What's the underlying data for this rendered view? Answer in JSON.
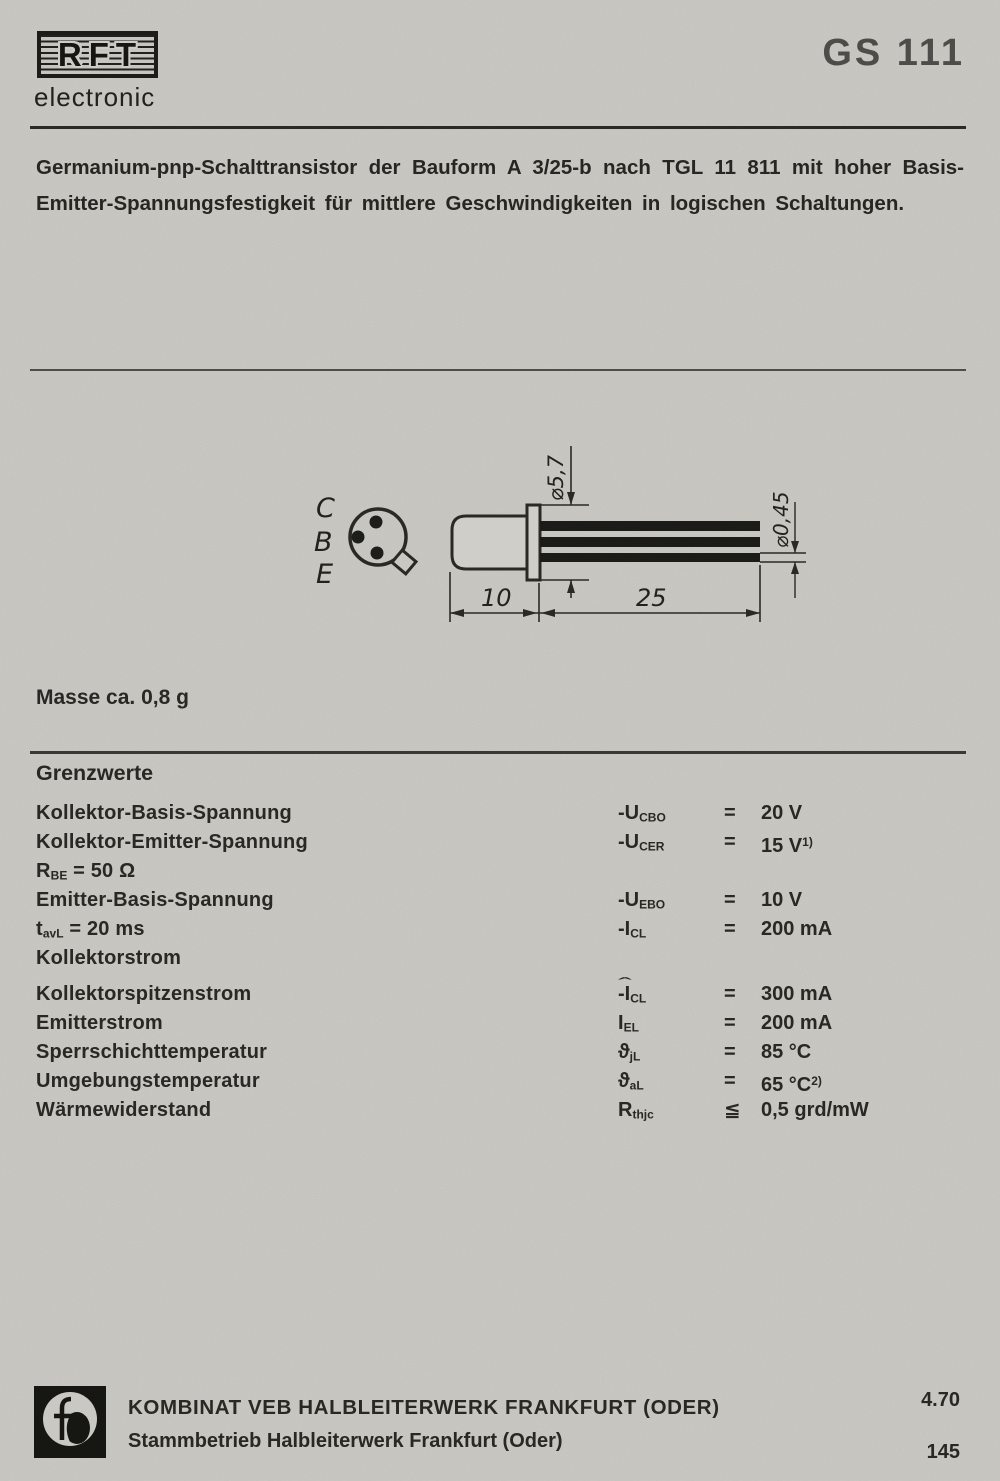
{
  "header": {
    "logo_text": "RFT",
    "logo_subtitle": "electronic",
    "part_number": "GS 111"
  },
  "description": {
    "line1": "Germanium-pnp-Schalttransistor der Bauform A 3/25-b nach TGL 11 811 mit hoher Basis-",
    "line2": "Emitter-Spannungsfestigkeit für mittlere Geschwindigkeiten in logischen Schaltungen."
  },
  "drawing": {
    "pins": [
      "C",
      "B",
      "E"
    ],
    "dim_flange_diameter": "⌀5,7",
    "dim_lead_diameter": "⌀0,45",
    "dim_body_length": "10",
    "dim_lead_length": "25"
  },
  "mass_note": "Masse ca. 0,8 g",
  "limits": {
    "heading": "Grenzwerte",
    "hat_glyph": "ˆ",
    "rows": [
      {
        "left": [
          {
            "t": "Kollektor-Basis-Spannung"
          }
        ],
        "sym": [
          {
            "t": "-U"
          },
          {
            "sub": "CBO"
          }
        ],
        "rel": "=",
        "val": "20 V"
      },
      {
        "left": [
          {
            "t": "Kollektor-Emitter-Spannung"
          }
        ],
        "sym": [
          {
            "t": "-U"
          },
          {
            "sub": "CER"
          }
        ],
        "rel": "=",
        "val": "15 V",
        "sup": "1)"
      },
      {
        "left": [
          {
            "t": "R"
          },
          {
            "sub": "BE"
          },
          {
            "t": " = 50 Ω"
          }
        ]
      },
      {
        "left": [
          {
            "t": "Emitter-Basis-Spannung"
          }
        ],
        "sym": [
          {
            "t": "-U"
          },
          {
            "sub": "EBO"
          }
        ],
        "rel": "=",
        "val": "10 V"
      },
      {
        "left": [
          {
            "t": "t"
          },
          {
            "sub": "avL"
          },
          {
            "t": " = 20 ms"
          }
        ],
        "sym": [
          {
            "t": "-I"
          },
          {
            "sub": "CL"
          }
        ],
        "rel": "=",
        "val": "200 mA"
      },
      {
        "left": [
          {
            "t": "Kollektorstrom"
          }
        ]
      },
      {
        "left": [
          {
            "t": "Kollektorspitzenstrom"
          }
        ],
        "sym": [
          {
            "t": "-I",
            "hat": true
          },
          {
            "sub": "CL"
          }
        ],
        "rel": "=",
        "val": "300 mA",
        "gap": true
      },
      {
        "left": [
          {
            "t": "Emitterstrom"
          }
        ],
        "sym": [
          {
            "t": "I"
          },
          {
            "sub": "EL"
          }
        ],
        "rel": "=",
        "val": "200 mA"
      },
      {
        "left": [
          {
            "t": "Sperrschichttemperatur"
          }
        ],
        "sym": [
          {
            "t": "ϑ"
          },
          {
            "sub": "jL"
          }
        ],
        "rel": "=",
        "val": "85 °C"
      },
      {
        "left": [
          {
            "t": "Umgebungstemperatur"
          }
        ],
        "sym": [
          {
            "t": "ϑ"
          },
          {
            "sub": "aL"
          }
        ],
        "rel": "=",
        "val": "65 °C",
        "sup": "2)"
      },
      {
        "left": [
          {
            "t": "Wärmewiderstand"
          }
        ],
        "sym": [
          {
            "t": "R"
          },
          {
            "sub": "thjc"
          }
        ],
        "rel": "≦",
        "val": "0,5 grd/mW"
      }
    ]
  },
  "footer": {
    "company_line1": "KOMBINAT VEB HALBLEITERWERK FRANKFURT (ODER)",
    "company_line2": "Stammbetrieb Halbleiterwerk Frankfurt (Oder)",
    "date_code": "4.70",
    "page_number": "145"
  }
}
